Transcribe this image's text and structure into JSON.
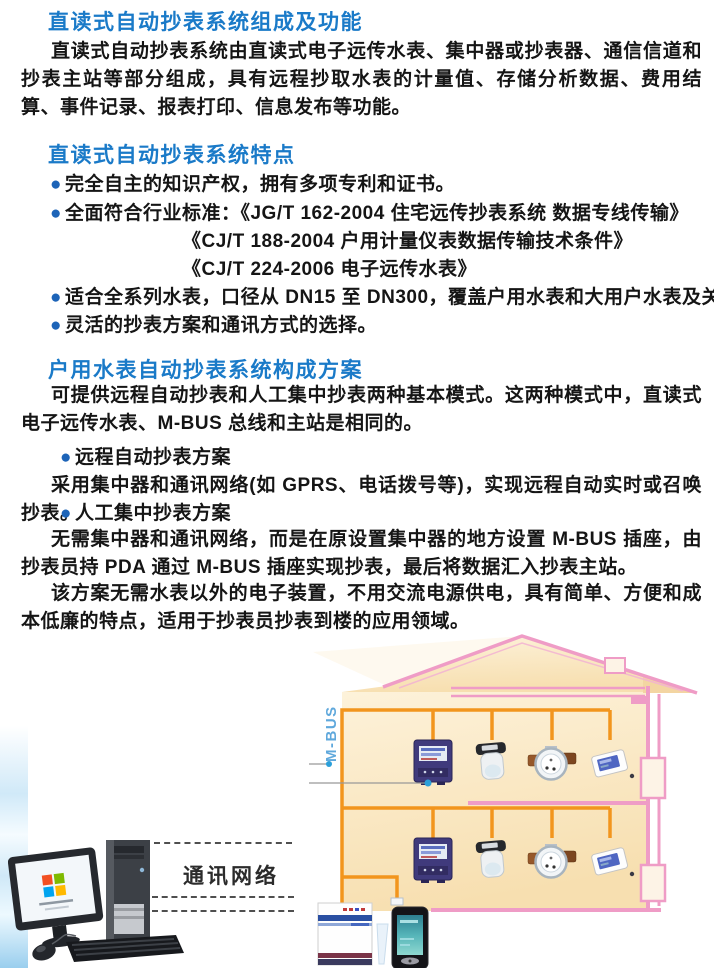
{
  "content": {
    "bullet_glyph": "●",
    "s1": {
      "heading": "直读式自动抄表系统组成及功能",
      "para": "直读式自动抄表系统由直读式电子远传水表、集中器或抄表器、通信信道和抄表主站等部分组成，具有远程抄取水表的计量值、存储分析数据、费用结算、事件记录、报表打印、信息发布等功能。"
    },
    "s2": {
      "heading": "直读式自动抄表系统特点",
      "b1": "完全自主的知识产权，拥有多项专利和证书。",
      "b2": "全面符合行业标准：《JG/T 162-2004 住宅远传抄表系统 数据专线传输》",
      "std2": "《CJ/T 188-2004 户用计量仪表数据传输技术条件》",
      "std3": "《CJ/T 224-2006 电子远传水表》",
      "b3": "适合全系列水表，口径从 DN15 至 DN300，覆盖户用水表和大用户水表及关口用表",
      "b4": "灵活的抄表方案和通讯方式的选择。"
    },
    "s3": {
      "heading": "户用水表自动抄表系统构成方案",
      "para1": "可提供远程自动抄表和人工集中抄表两种基本模式。这两种模式中，直读式电子远传水表、M-BUS 总线和主站是相同的。",
      "b1": "远程自动抄表方案",
      "para2": "采用集中器和通讯网络(如 GPRS、电话拨号等)，实现远程自动实时或召唤抄表。",
      "b2": "人工集中抄表方案",
      "para3": "无需集中器和通讯网络，而是在原设置集中器的地方设置 M-BUS 插座，由抄表员持 PDA 通过 M-BUS 插座实现抄表，最后将数据汇入抄表主站。",
      "para4": "该方案无需水表以外的电子装置，不用交流电源供电，具有简单、方便和成本低廉的特点，适用于抄表员抄表到楼的应用领域。"
    },
    "illustration": {
      "mbus_label": "M-BUS",
      "network_label": "通讯网络",
      "icons": [
        "computer-icon",
        "house-icon",
        "electric-meter-icon",
        "gas-meter-icon",
        "water-meter-icon",
        "card-meter-icon",
        "concentrator-icon",
        "pda-icon",
        "mbus-socket-icon"
      ]
    },
    "colors": {
      "heading_blue": "#1a7ac8",
      "bullet_blue": "#1d64b8",
      "mbus_text_blue": "#5fa8dc",
      "bus_orange": "#f2951d",
      "house_pink": "#ef9cc6",
      "house_fill": "#fbe8c4",
      "pointer_dot_blue": "#2b9fd9"
    }
  }
}
